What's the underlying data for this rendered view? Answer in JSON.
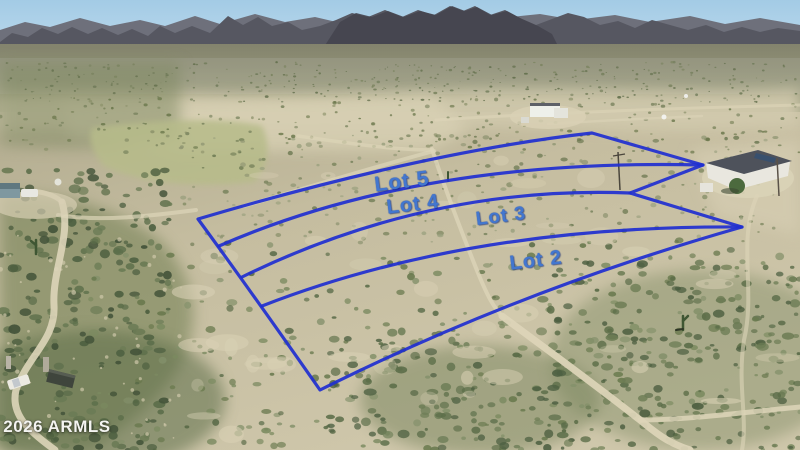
{
  "watermark": {
    "text": "© 2026 ARMLS"
  },
  "overlay": {
    "line_color": "#1f2fd0",
    "label_color": "#4377cf",
    "outline_path": "M198,219 Q424,152 592,133 L703,165 L630,193 L742,227 Q520,290 320,390 Q250,290 198,219 Z",
    "division_paths": [
      "M219,246 Q420,158 703,165",
      "M242,277 Q430,185 630,193",
      "M262,306 Q470,225 742,227"
    ],
    "labels": [
      {
        "text": "Lot 5",
        "x": 402,
        "y": 182,
        "size": 21
      },
      {
        "text": "Lot 4",
        "x": 413,
        "y": 205,
        "size": 20
      },
      {
        "text": "Lot 3",
        "x": 501,
        "y": 217,
        "size": 19
      },
      {
        "text": "Lot 2",
        "x": 536,
        "y": 261,
        "size": 20
      }
    ]
  },
  "scene": {
    "sky_color": "#a9cfe7",
    "mountain_color": "#565761",
    "terrain_color": "#c7bfa2",
    "road_color": "#ddd5b9"
  }
}
